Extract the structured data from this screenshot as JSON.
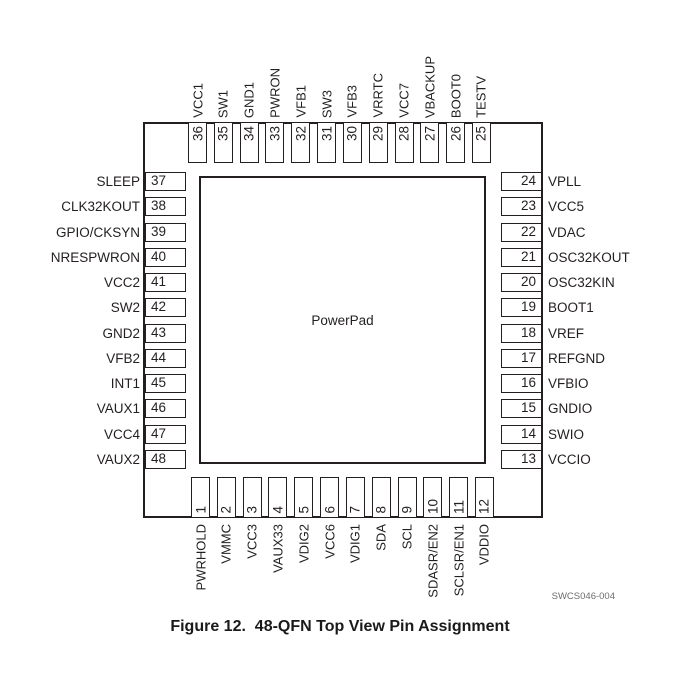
{
  "figure": {
    "center_label": "PowerPad",
    "doc_code": "SWCS046-004",
    "caption": "Figure 12.  48-QFN Top View Pin Assignment"
  },
  "colors": {
    "line": "#231f20",
    "text": "#231f20",
    "doc_code_gray": "#6d6d6d",
    "background": "#ffffff"
  },
  "pins": {
    "top": [
      {
        "num": "36",
        "label": "VCC1"
      },
      {
        "num": "35",
        "label": "SW1"
      },
      {
        "num": "34",
        "label": "GND1"
      },
      {
        "num": "33",
        "label": "PWRON"
      },
      {
        "num": "32",
        "label": "VFB1"
      },
      {
        "num": "31",
        "label": "SW3"
      },
      {
        "num": "30",
        "label": "VFB3"
      },
      {
        "num": "29",
        "label": "VRRTC"
      },
      {
        "num": "28",
        "label": "VCC7"
      },
      {
        "num": "27",
        "label": "VBACKUP"
      },
      {
        "num": "26",
        "label": "BOOT0"
      },
      {
        "num": "25",
        "label": "TESTV"
      }
    ],
    "left": [
      {
        "num": "37",
        "label": "SLEEP"
      },
      {
        "num": "38",
        "label": "CLK32KOUT"
      },
      {
        "num": "39",
        "label": "GPIO/CKSYN"
      },
      {
        "num": "40",
        "label": "NRESPWRON"
      },
      {
        "num": "41",
        "label": "VCC2"
      },
      {
        "num": "42",
        "label": "SW2"
      },
      {
        "num": "43",
        "label": "GND2"
      },
      {
        "num": "44",
        "label": "VFB2"
      },
      {
        "num": "45",
        "label": "INT1"
      },
      {
        "num": "46",
        "label": "VAUX1"
      },
      {
        "num": "47",
        "label": "VCC4"
      },
      {
        "num": "48",
        "label": "VAUX2"
      }
    ],
    "right": [
      {
        "num": "24",
        "label": "VPLL"
      },
      {
        "num": "23",
        "label": "VCC5"
      },
      {
        "num": "22",
        "label": "VDAC"
      },
      {
        "num": "21",
        "label": "OSC32KOUT"
      },
      {
        "num": "20",
        "label": "OSC32KIN"
      },
      {
        "num": "19",
        "label": "BOOT1"
      },
      {
        "num": "18",
        "label": "VREF"
      },
      {
        "num": "17",
        "label": "REFGND"
      },
      {
        "num": "16",
        "label": "VFBIO"
      },
      {
        "num": "15",
        "label": "GNDIO"
      },
      {
        "num": "14",
        "label": "SWIO"
      },
      {
        "num": "13",
        "label": "VCCIO"
      }
    ],
    "bottom": [
      {
        "num": "1",
        "label": "PWRHOLD"
      },
      {
        "num": "2",
        "label": "VMMC"
      },
      {
        "num": "3",
        "label": "VCC3"
      },
      {
        "num": "4",
        "label": "VAUX33"
      },
      {
        "num": "5",
        "label": "VDIG2"
      },
      {
        "num": "6",
        "label": "VCC6"
      },
      {
        "num": "7",
        "label": "VDIG1"
      },
      {
        "num": "8",
        "label": "SDA"
      },
      {
        "num": "9",
        "label": "SCL"
      },
      {
        "num": "10",
        "label": "SDASR/EN2"
      },
      {
        "num": "11",
        "label": "SCLSR/EN1"
      },
      {
        "num": "12",
        "label": "VDDIO"
      }
    ]
  }
}
